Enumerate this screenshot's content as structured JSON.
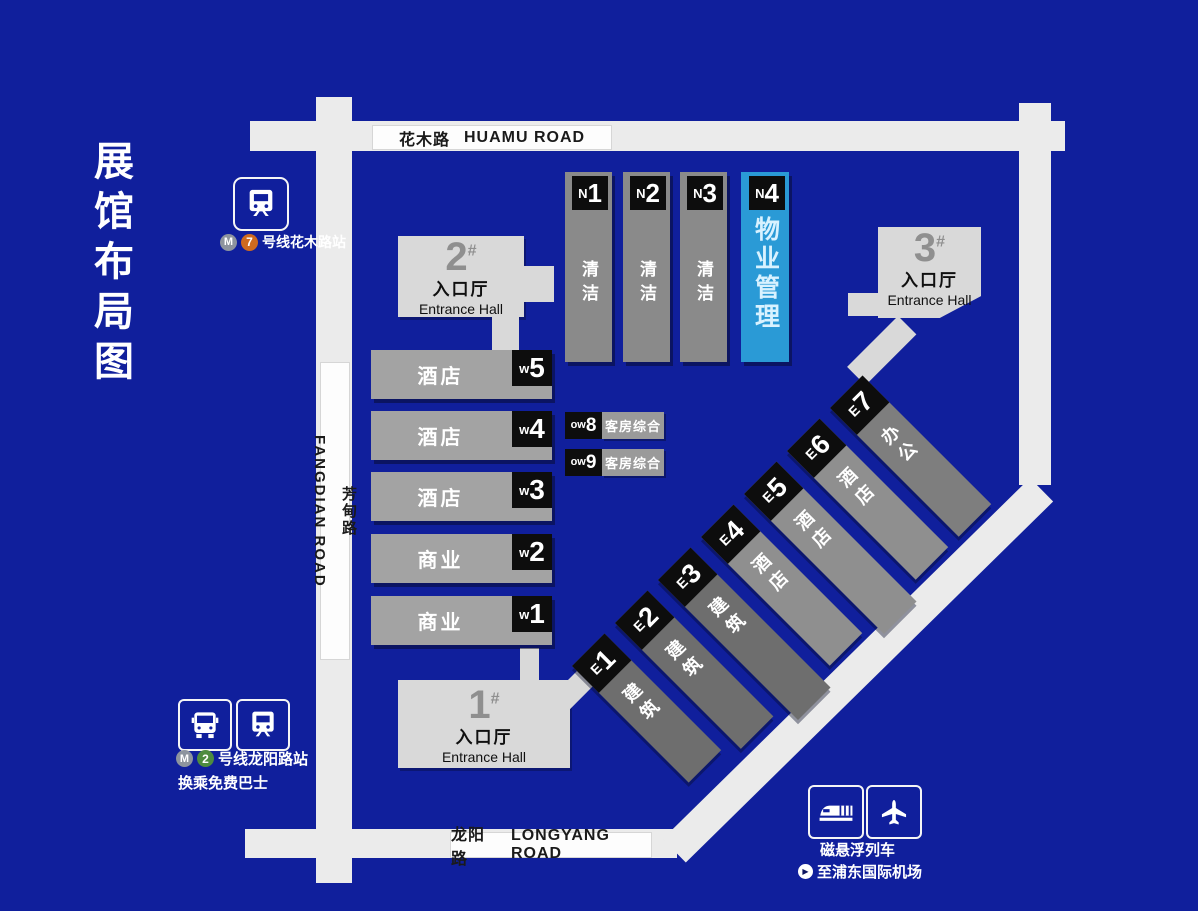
{
  "title": "展馆布局图",
  "roads": {
    "huamu": {
      "zh": "花木路",
      "en": "HUAMU ROAD"
    },
    "fangdian": {
      "zh": "芳甸路",
      "en": "FANGDIAN ROAD"
    },
    "longyang": {
      "zh": "龙阳路",
      "en": "LONGYANG ROAD"
    }
  },
  "entrance_halls": [
    {
      "num": "1",
      "hash": "#",
      "zh": "入口厅",
      "en": "Entrance Hall"
    },
    {
      "num": "2",
      "hash": "#",
      "zh": "入口厅",
      "en": "Entrance Hall"
    },
    {
      "num": "3",
      "hash": "#",
      "zh": "入口厅",
      "en": "Entrance Hall"
    }
  ],
  "north_halls": [
    {
      "prefix": "N",
      "num": "1",
      "use": "清洁"
    },
    {
      "prefix": "N",
      "num": "2",
      "use": "清洁"
    },
    {
      "prefix": "N",
      "num": "3",
      "use": "清洁"
    },
    {
      "prefix": "N",
      "num": "4",
      "use": "物业管理",
      "highlight": true
    }
  ],
  "west_halls": [
    {
      "prefix": "w",
      "num": "5",
      "use": "酒店"
    },
    {
      "prefix": "w",
      "num": "4",
      "use": "酒店"
    },
    {
      "prefix": "w",
      "num": "3",
      "use": "酒店"
    },
    {
      "prefix": "w",
      "num": "2",
      "use": "商业"
    },
    {
      "prefix": "w",
      "num": "1",
      "use": "商业"
    }
  ],
  "ow_halls": [
    {
      "prefix": "ow",
      "num": "8",
      "use": "客房综合"
    },
    {
      "prefix": "ow",
      "num": "9",
      "use": "客房综合"
    }
  ],
  "east_halls": [
    {
      "prefix": "E",
      "num": "1",
      "use": "建筑"
    },
    {
      "prefix": "E",
      "num": "2",
      "use": "建筑"
    },
    {
      "prefix": "E",
      "num": "3",
      "use": "建筑"
    },
    {
      "prefix": "E",
      "num": "4",
      "use": "酒店"
    },
    {
      "prefix": "E",
      "num": "5",
      "use": "酒店"
    },
    {
      "prefix": "E",
      "num": "6",
      "use": "酒店"
    },
    {
      "prefix": "E",
      "num": "7",
      "use": "办公"
    }
  ],
  "transit": {
    "metro_logo": "M",
    "line7": {
      "line_num": "7",
      "station": "号线花木路站"
    },
    "line2": {
      "line_num": "2",
      "station": "号线龙阳路站",
      "note": "换乘免费巴士"
    },
    "maglev": {
      "name": "磁悬浮列车",
      "dest": "至浦东国际机场",
      "play": "▶"
    }
  },
  "colors": {
    "background": "#101f9c",
    "road": "#ebebeb",
    "hall_gray": "#8a8a8a",
    "hall_light_gray": "#a3a3a3",
    "entrance_gray": "#d9d9d9",
    "highlight_blue": "#2a9ad6",
    "tag_black": "#0d0d0d",
    "line7_orange": "#cf6a1f",
    "line2_green": "#4e8c3f"
  }
}
